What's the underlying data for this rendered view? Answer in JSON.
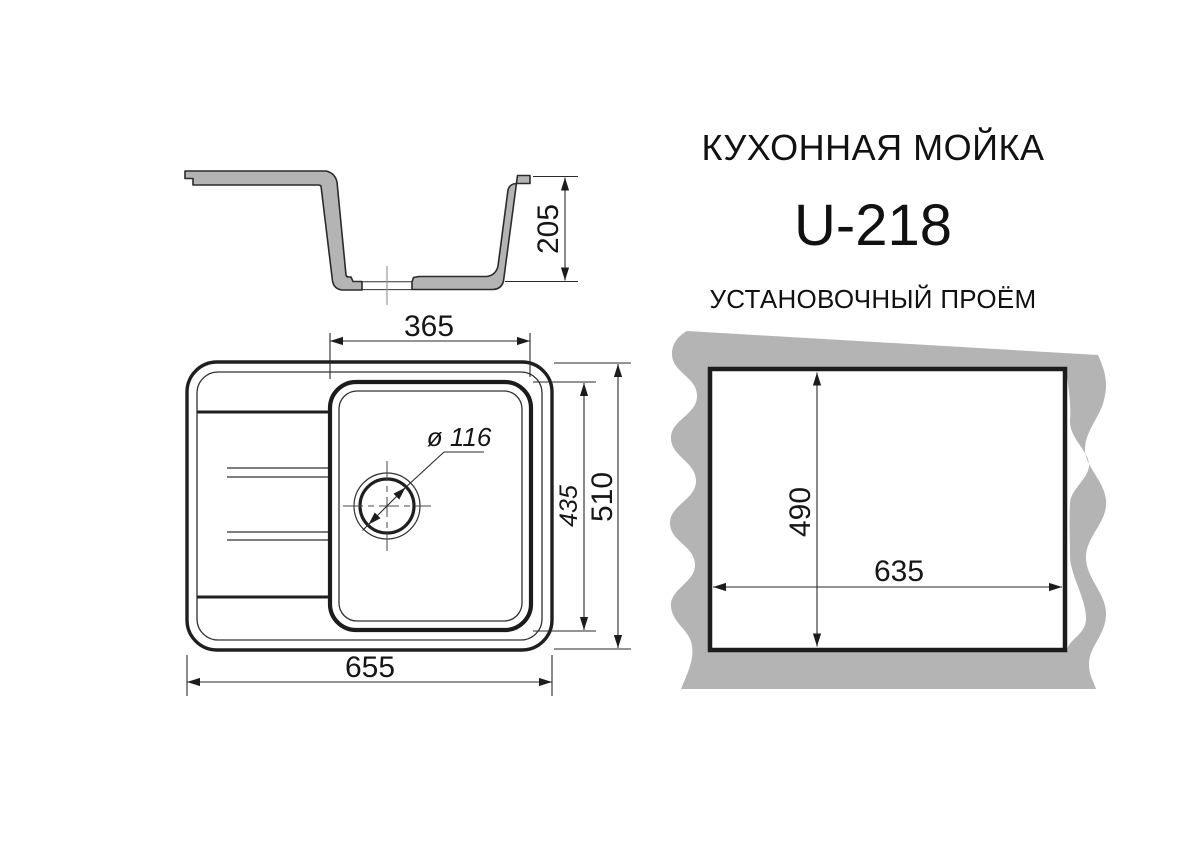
{
  "titles": {
    "product": "КУХОННАЯ МОЙКА",
    "model": "U-218",
    "cutout_section": "УСТАНОВОЧНЫЙ ПРОЁМ"
  },
  "dimensions": {
    "section_height": "205",
    "bowl_width": "365",
    "bowl_length": "435",
    "sink_length": "510",
    "sink_width": "655",
    "drain_diameter": "ø 116",
    "cutout_length": "490",
    "cutout_width": "635"
  },
  "colors": {
    "ink": "#1f1f1f",
    "material_gray": "#b4b4b4",
    "centerline_gray": "#999999",
    "background": "#ffffff"
  }
}
